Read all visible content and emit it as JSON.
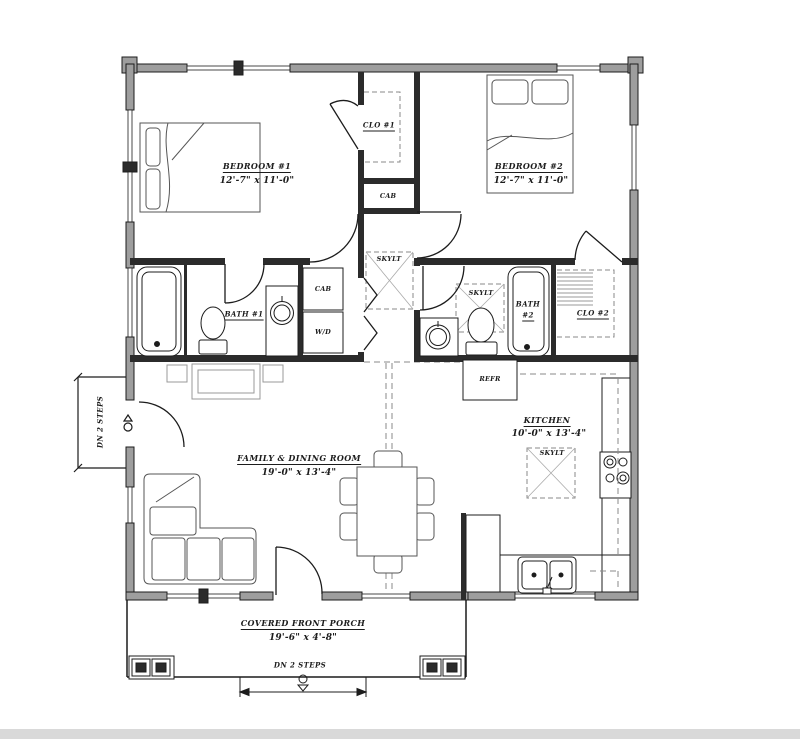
{
  "plan": {
    "rooms": {
      "bedroom1": {
        "name": "BEDROOM #1",
        "dims": "12'-7\" x 11'-0\""
      },
      "bedroom2": {
        "name": "BEDROOM #2",
        "dims": "12'-7\" x 11'-0\""
      },
      "family_dining": {
        "name": "FAMILY & DINING ROOM",
        "dims": "19'-0\" x 13'-4\""
      },
      "kitchen": {
        "name": "KITCHEN",
        "dims": "10'-0\" x 13'-4\""
      },
      "bath1": {
        "name": "BATH #1"
      },
      "bath2": {
        "name_line1": "BATH",
        "name_line2": "#2"
      },
      "closet1": {
        "name": "CLO #1"
      },
      "closet2": {
        "name": "CLO #2"
      },
      "porch": {
        "name": "COVERED FRONT PORCH",
        "dims": "19'-6\" x 4'-8\""
      }
    },
    "fixtures": {
      "hall_cabinet": "CAB",
      "bath_cabinet": "CAB",
      "washer_dryer": "W/D",
      "refrigerator": "REFR",
      "skylight_hall": "SKYLT",
      "skylight_bath2": "SKYLT",
      "skylight_kitchen": "SKYLT"
    },
    "annotations": {
      "porch_steps": "DN 2 STEPS",
      "side_entry_steps": "DN 2 STEPS"
    },
    "colors": {
      "wall_fill": "#9e9e9e",
      "line": "#1c1c1c",
      "furniture": "#555555",
      "light_gray": "#999999",
      "dash": "#8a8a8a",
      "footer_bar": "#d9d9d9"
    }
  }
}
